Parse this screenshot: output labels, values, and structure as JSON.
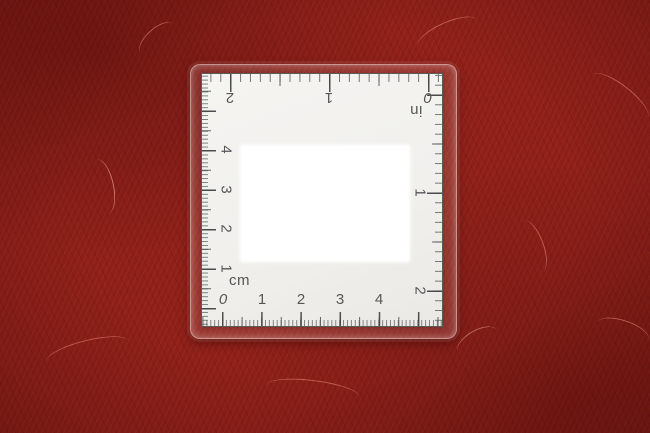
{
  "scene": {
    "fabric_color": "#8e2019",
    "card_color": "#f2f1ed",
    "patch_color": "#ffffff",
    "ink_color": "#565656"
  },
  "ruler": {
    "bottom_scale": {
      "unit_label": "cm",
      "numbers": [
        "0",
        "1",
        "2",
        "3",
        "4"
      ]
    },
    "left_scale": {
      "numbers": [
        "1",
        "2",
        "3",
        "4"
      ]
    },
    "top_scale": {
      "unit_label": "in",
      "numbers": [
        "2",
        "1",
        "0"
      ]
    },
    "right_scale": {
      "numbers": [
        "1",
        "2"
      ]
    }
  }
}
